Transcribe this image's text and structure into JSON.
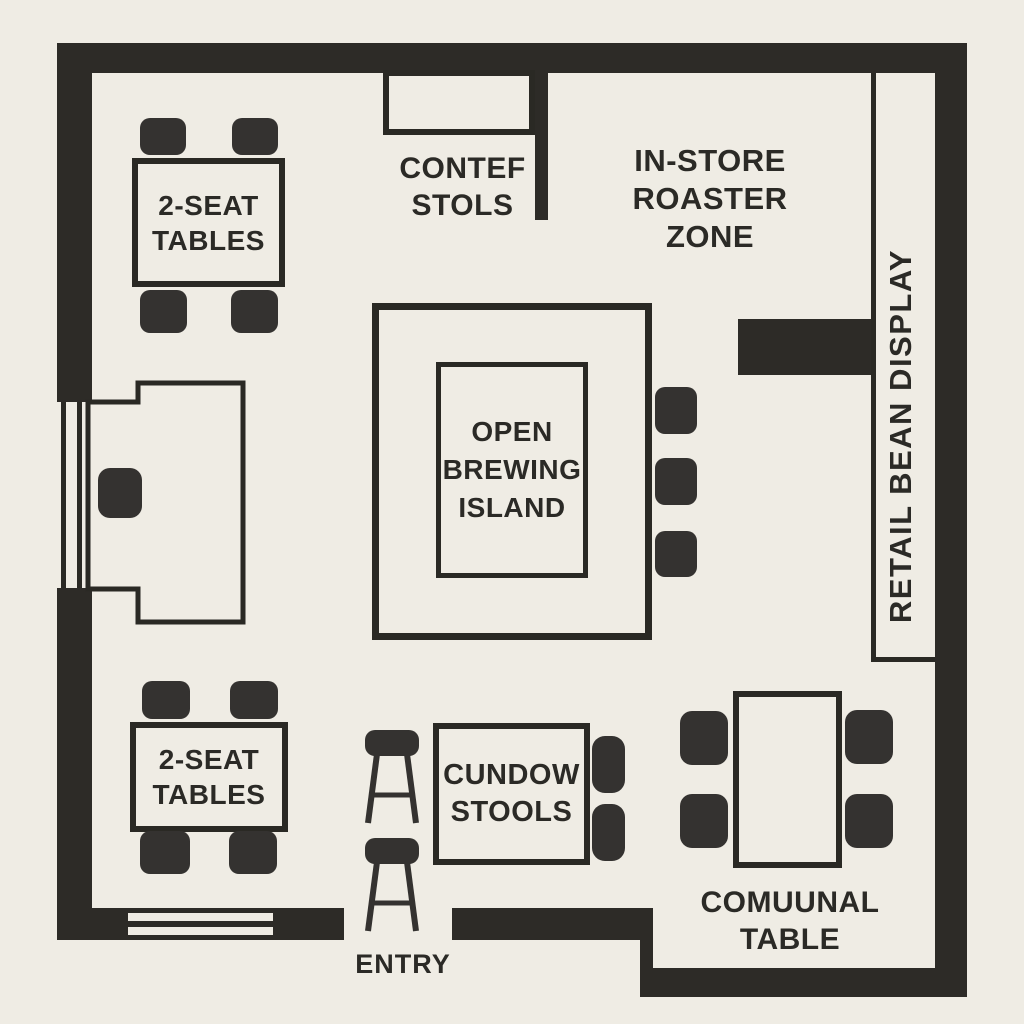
{
  "colors": {
    "bg": "#EFECE4",
    "wall": "#2D2B27",
    "furn": "#343230",
    "line": "#2A2924",
    "text": "#2B2A26"
  },
  "floor_plan": {
    "labels": {
      "counter_stools": "CONTEF STOLS",
      "roaster_zone": "IN-STORE ROASTER ZONE",
      "two_seat_tables_top": "2-SEAT TABLES",
      "brewing_island": "OPEN BREWING ISLAND",
      "retail_bean_display": "RETAIL BEAN DISPLAY",
      "window_stools": "CUNDOW STOOLS",
      "two_seat_tables_bottom": "2-SEAT TABLES",
      "communal_table": "COMUUNAL TABLE",
      "entry": "ENTRY"
    },
    "icons": [
      "stool-side-icon",
      "chair-icon",
      "window-icon"
    ]
  }
}
